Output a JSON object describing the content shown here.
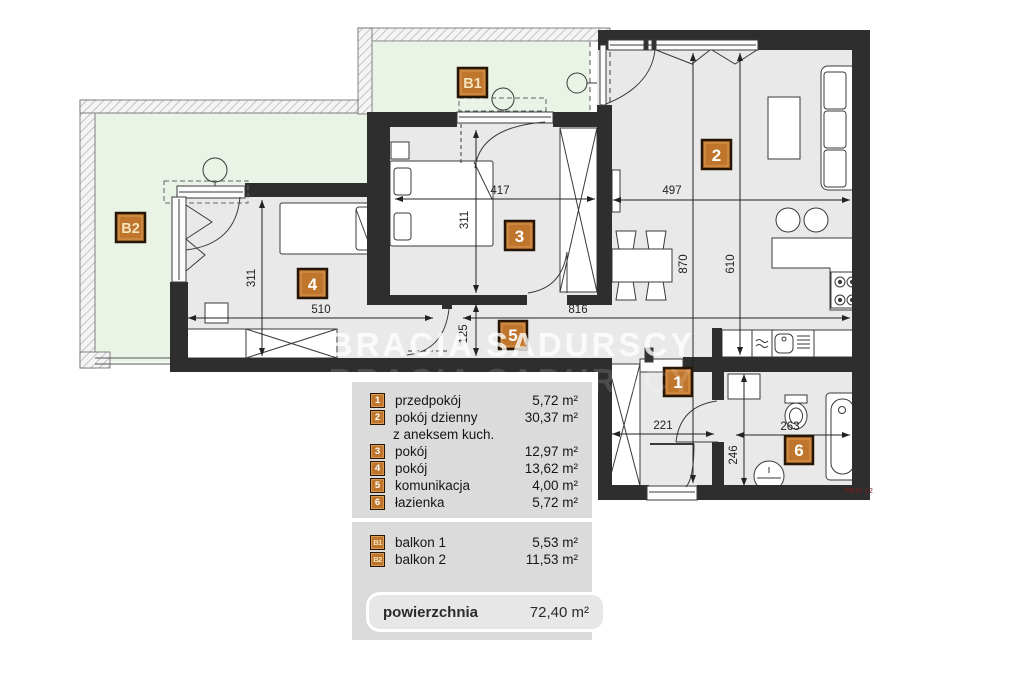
{
  "watermark": {
    "text": "BRACIA SADURSCY"
  },
  "plan": {
    "ref_text": "REIS 12",
    "colors": {
      "wall": "#2e2e2e",
      "room_fill": "#e9e9e9",
      "balcony_fill": "#e9f3e6",
      "badge": "#bf762c",
      "badge_border": "#241505"
    },
    "dims": {
      "r3_w": "417",
      "r2_w": "497",
      "r3_h": "311",
      "r4_h": "311",
      "r4_w": "510",
      "corridor_w": "816",
      "corridor_h": "125",
      "living_h_a": "870",
      "living_h_b": "610",
      "hall_w": "221",
      "bath_w": "263",
      "bath_h": "246"
    }
  },
  "legend": {
    "rooms": [
      {
        "badge": "1",
        "name": "przedpokój",
        "area": "5,72 m²"
      },
      {
        "badge": "2",
        "name": "pokój dzienny",
        "name2": "z aneksem kuch.",
        "area": "30,37 m²"
      },
      {
        "badge": "3",
        "name": "pokój",
        "area": "12,97 m²"
      },
      {
        "badge": "4",
        "name": "pokój",
        "area": "13,62 m²"
      },
      {
        "badge": "5",
        "name": "komunikacja",
        "area": "4,00 m²"
      },
      {
        "badge": "6",
        "name": "łazienka",
        "area": "5,72 m²"
      }
    ],
    "balconies": [
      {
        "badge": "B1",
        "name": "balkon 1",
        "area": "5,53 m²"
      },
      {
        "badge": "B2",
        "name": "balkon 2",
        "area": "11,53 m²"
      }
    ],
    "total": {
      "label": "powierzchnia",
      "value": "72,40 m²"
    }
  }
}
